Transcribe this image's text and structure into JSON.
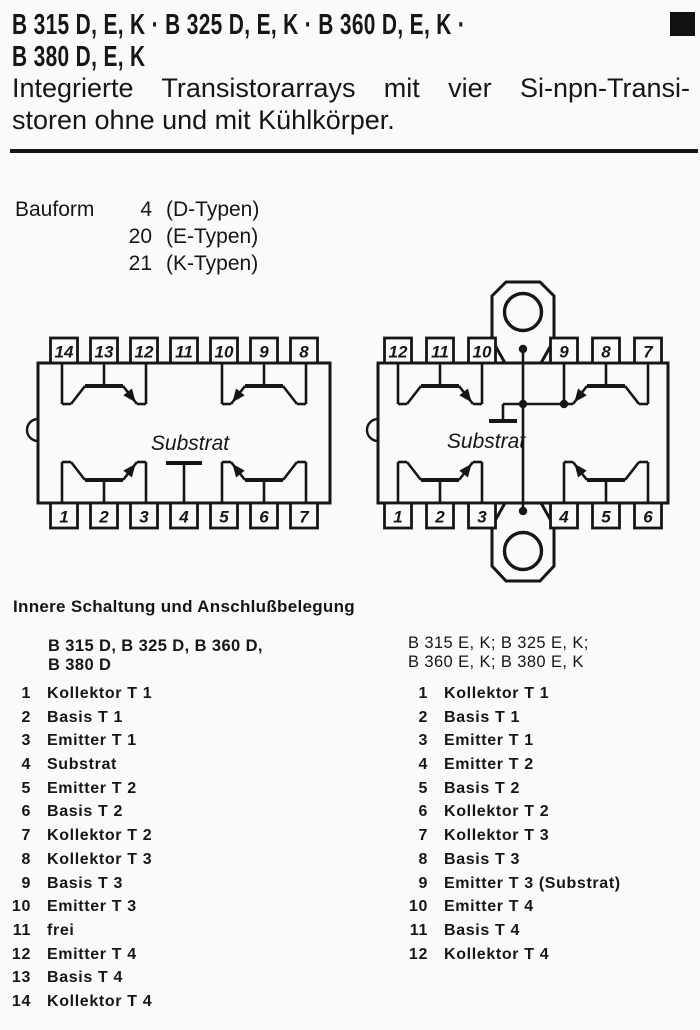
{
  "colors": {
    "ink": "#161616",
    "paper": "#fafaf8"
  },
  "header": {
    "title_line1": "B 315 D, E, K · B 325 D, E, K · B 360 D, E, K ·",
    "title_line2": "B 380 D, E, K",
    "subtitle_line1": "Integrierte Transistorarrays mit vier Si-npn-Transi-",
    "subtitle_line2": "storen ohne und mit Kühlkörper."
  },
  "bauform": {
    "label": "Bauform",
    "rows": [
      {
        "num": "4",
        "type": "(D-Typen)"
      },
      {
        "num": "20",
        "type": "(E-Typen)"
      },
      {
        "num": "21",
        "type": "(K-Typen)"
      }
    ]
  },
  "diagrams": {
    "left_package": {
      "top_pins": [
        "14",
        "13",
        "12",
        "11",
        "10",
        "9",
        "8"
      ],
      "bottom_pins": [
        "1",
        "2",
        "3",
        "4",
        "5",
        "6",
        "7"
      ],
      "substrate_label": "Substrat"
    },
    "right_package": {
      "top_pins": [
        "12",
        "11",
        "10",
        "9",
        "8",
        "7"
      ],
      "bottom_pins": [
        "1",
        "2",
        "3",
        "4",
        "5",
        "6"
      ],
      "substrate_label": "Substrat"
    }
  },
  "pinout_section": {
    "heading": "Innere Schaltung und Anschlußbelegung",
    "left_column": {
      "header_line1": "B 315 D, B 325 D, B 360 D,",
      "header_line2": "B 380 D",
      "pins": [
        {
          "num": "1",
          "label": "Kollektor T 1"
        },
        {
          "num": "2",
          "label": "Basis T 1"
        },
        {
          "num": "3",
          "label": "Emitter T 1"
        },
        {
          "num": "4",
          "label": "Substrat"
        },
        {
          "num": "5",
          "label": "Emitter T 2"
        },
        {
          "num": "6",
          "label": "Basis T 2"
        },
        {
          "num": "7",
          "label": "Kollektor T 2"
        },
        {
          "num": "8",
          "label": "Kollektor T 3"
        },
        {
          "num": "9",
          "label": "Basis T 3"
        },
        {
          "num": "10",
          "label": "Emitter T 3"
        },
        {
          "num": "11",
          "label": "frei"
        },
        {
          "num": "12",
          "label": "Emitter T 4"
        },
        {
          "num": "13",
          "label": "Basis T 4"
        },
        {
          "num": "14",
          "label": "Kollektor T 4"
        }
      ]
    },
    "right_column": {
      "header_line1": "B 315 E, K; B 325 E, K;",
      "header_line2": "B 360 E, K; B 380 E, K",
      "pins": [
        {
          "num": "1",
          "label": "Kollektor T 1"
        },
        {
          "num": "2",
          "label": "Basis T 1"
        },
        {
          "num": "3",
          "label": "Emitter T 1"
        },
        {
          "num": "4",
          "label": "Emitter T 2"
        },
        {
          "num": "5",
          "label": "Basis T 2"
        },
        {
          "num": "6",
          "label": "Kollektor T 2"
        },
        {
          "num": "7",
          "label": "Kollektor T 3"
        },
        {
          "num": "8",
          "label": "Basis T 3"
        },
        {
          "num": "9",
          "label": "Emitter T 3 (Substrat)"
        },
        {
          "num": "10",
          "label": "Emitter T 4"
        },
        {
          "num": "11",
          "label": "Basis T 4"
        },
        {
          "num": "12",
          "label": "Kollektor T 4"
        }
      ]
    }
  }
}
